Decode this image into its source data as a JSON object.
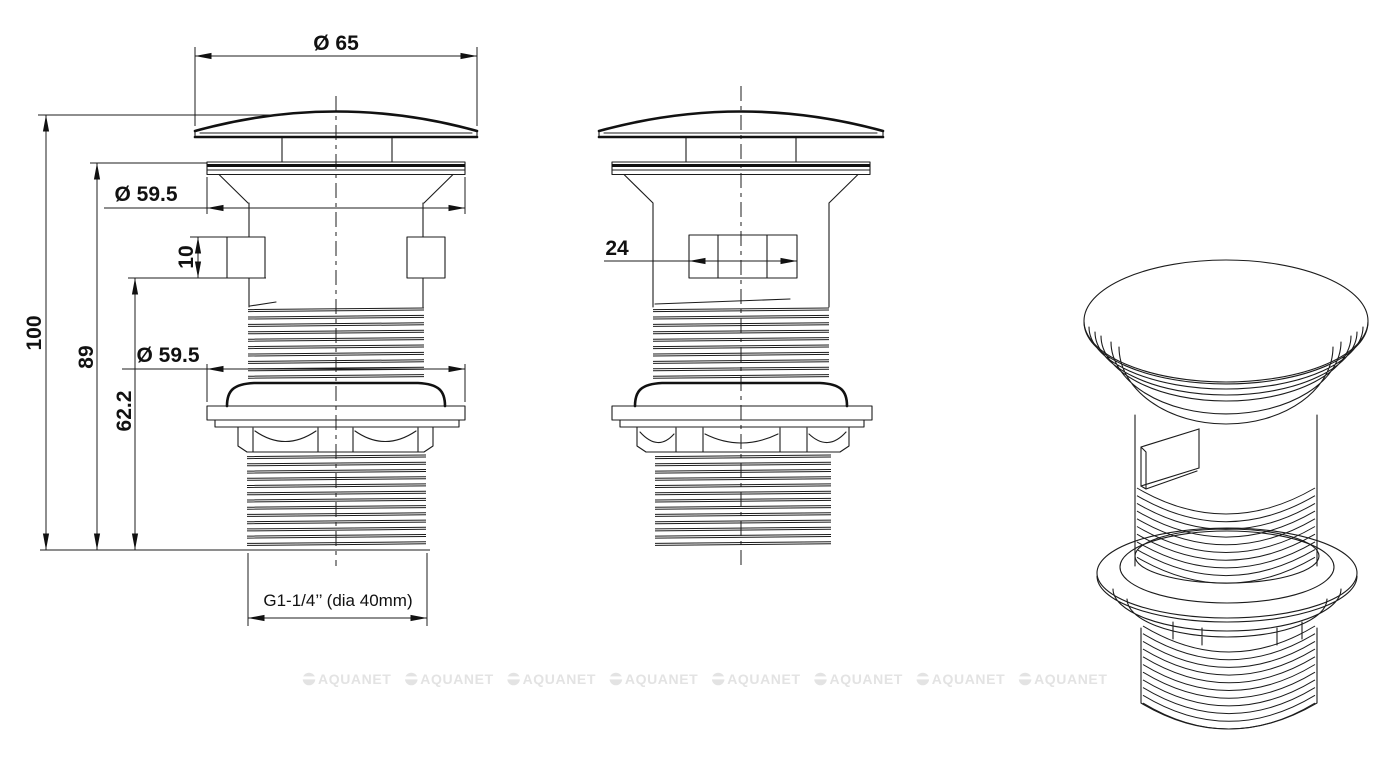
{
  "drawing": {
    "dimensions": {
      "cap_diameter": "Ø 65",
      "flange_diameter_top": "Ø 59.5",
      "notch_height": "10",
      "overall_height": "100",
      "height_to_flange": "89",
      "height_to_notch": "62.2",
      "flange_diameter_lower": "Ø 59.5",
      "slot_width": "24",
      "thread_spec": "G1-1/4’’ (dia 40mm)"
    },
    "watermark": {
      "text": "AQUANET",
      "count": 8,
      "color": "#e3e3e3"
    }
  }
}
